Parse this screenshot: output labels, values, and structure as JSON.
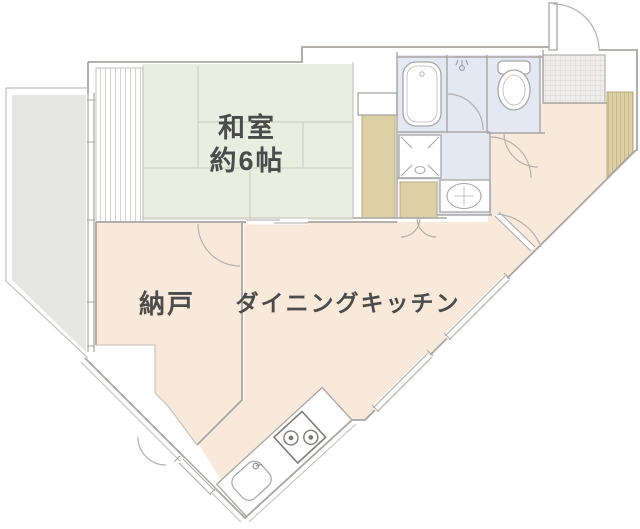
{
  "floorplan": {
    "rooms": {
      "washitsu": {
        "name_line1": "和室",
        "name_line2": "約6帖",
        "color": "#e9eee1"
      },
      "nando": {
        "name": "納戸",
        "color": "#f9e9db"
      },
      "dining_kitchen": {
        "name": "ダイニングキッチン",
        "color": "#f9e9db"
      },
      "hall": {
        "color": "#f9e9db"
      },
      "balcony": {
        "color": "#e6e6e4"
      },
      "bathroom": {
        "color": "#e3e8f2"
      },
      "washroom": {
        "color": "#e3e8f2"
      },
      "toilet": {
        "color": "#e3e8f2"
      },
      "genkan_tile": {
        "color": "#efeeec"
      },
      "closet": {
        "color": "#ddd0a5"
      },
      "engawa_stripe": {
        "color": "#ffffff"
      }
    },
    "fixtures": [
      "bathtub",
      "toilet",
      "washbasin",
      "washing-machine-pan",
      "kitchen-sink",
      "gas-stove",
      "entrance-door",
      "balcony",
      "closet",
      "genkan-tile"
    ],
    "wall_color": "#a9a6a3",
    "tatami_line_color": "#ccd3bf",
    "text_color": "#4b4b4b"
  }
}
